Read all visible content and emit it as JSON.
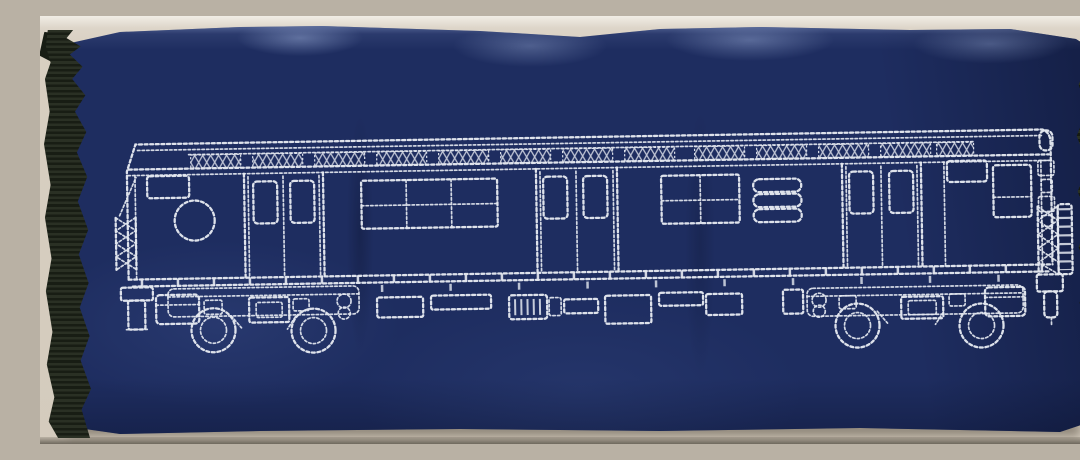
{
  "scene": {
    "type": "photograph",
    "subject": "navy fabric pouch with white embroidered outline of a subway car",
    "background_surface": "beige tabletop",
    "fabric": {
      "material": "navy blue fabric with soft wrinkles",
      "trim": "black grosgrain binding along left and right edges"
    },
    "embroidery": {
      "style": "white machine running-stitch outline drawing",
      "subject": "side elevation of a New York style subway car",
      "features": [
        "roof edge with cross-hatched vent band segments",
        "three sets of double passenger doors with small upper windows",
        "multi-pane side windows with horizontal dividers",
        "round route sign and small destination sign at left cab",
        "cab sign and divided cab window at right end",
        "diamond lattice safety gates at both car ends",
        "two wheel trucks with journal boxes and springs",
        "underbody equipment boxes including a ribbed battery box",
        "end posts and couplers"
      ]
    }
  },
  "colors": {
    "surface": "#d8cfc1",
    "surface_shadow": "#6f695e",
    "fabric_navy": "#1e2d60",
    "fabric_highlight": "#5a6fa8",
    "binding_dark": "#181d14",
    "binding_ridge": "#2a3024",
    "stitch_white": "#e4e8f0"
  }
}
